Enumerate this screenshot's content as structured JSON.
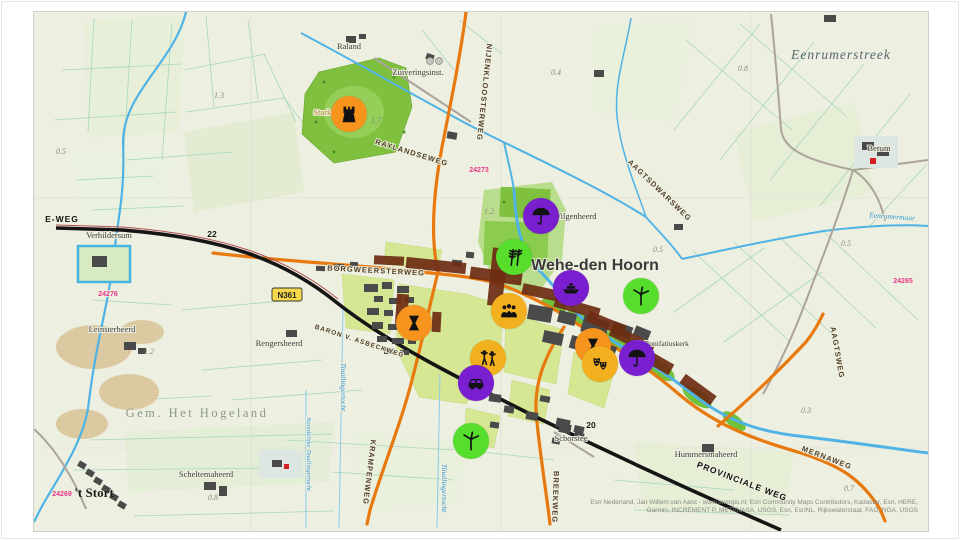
{
  "map": {
    "town_label": "Wehe-den Hoorn",
    "shield": {
      "text": "N361"
    },
    "region_labels": [
      {
        "text": "Eenrumerstreek",
        "x": 807,
        "y": 47
      },
      {
        "text": "Gem. Het Hogeland",
        "x": 163,
        "y": 405
      },
      {
        "text": "'t Stort",
        "x": 60,
        "y": 485
      }
    ],
    "place_labels": [
      {
        "text": "Raland",
        "x": 315,
        "y": 37
      },
      {
        "text": "Zuiveringsinst.",
        "x": 384,
        "y": 63
      },
      {
        "text": "Verhildersum",
        "x": 75,
        "y": 226
      },
      {
        "text": "Wilgenheerd",
        "x": 519,
        "y": 207,
        "anchor": "start"
      },
      {
        "text": "Leinsterheerd",
        "x": 78,
        "y": 320
      },
      {
        "text": "Rengersheerd",
        "x": 245,
        "y": 334
      },
      {
        "text": "Scheltemaheerd",
        "x": 172,
        "y": 465
      },
      {
        "text": "Schorstee",
        "x": 537,
        "y": 429
      },
      {
        "text": "Hummersmaheerd",
        "x": 672,
        "y": 445
      },
      {
        "text": "Berum",
        "x": 845,
        "y": 139
      },
      {
        "text": "H. Bonifatiuskerk",
        "x": 628,
        "y": 334,
        "size": 7.5
      },
      {
        "text": "Starkenborg",
        "x": 300,
        "y": 103,
        "cls": "lbl-park"
      }
    ],
    "road_labels": [
      {
        "text": "E-WEG",
        "x": 28,
        "y": 210,
        "cls": "lbl-road-black"
      },
      {
        "text": "BORGWEERSTERWEG",
        "x": 342,
        "y": 261,
        "rot": 3
      },
      {
        "text": "RAYLANDSEWEG",
        "x": 377,
        "y": 143,
        "rot": 17
      },
      {
        "text": "NIJENKLOOSTERWEG",
        "x": 448,
        "y": 80,
        "rot": 96
      },
      {
        "text": "AAGTSDWARSWEG",
        "x": 624,
        "y": 180,
        "rot": 44
      },
      {
        "text": "AAGTSWEG",
        "x": 801,
        "y": 341,
        "rot": 80
      },
      {
        "text": "MERNAWEG",
        "x": 792,
        "y": 448,
        "rot": 21
      },
      {
        "text": "BREEKWEG",
        "x": 519,
        "y": 485,
        "rot": 92
      },
      {
        "text": "KRAMPENWEG",
        "x": 333,
        "y": 460,
        "rot": 97
      },
      {
        "text": "BARON V. ASBECKWEG",
        "x": 325,
        "y": 331,
        "rot": 18,
        "size": 6.5
      },
      {
        "text": "PROVINCIALE WEG",
        "x": 707,
        "y": 472,
        "rot": 21,
        "cls": "lbl-road-black"
      }
    ],
    "water_labels": [
      {
        "text": "Eenrumermaar",
        "x": 858,
        "y": 207,
        "rot": 4
      },
      {
        "text": "Tinallingertocht",
        "x": 307,
        "y": 375,
        "rot": 90
      },
      {
        "text": "Noordelijke Tinallingertocht",
        "x": 273,
        "y": 442,
        "rot": 90,
        "size": 6.5
      },
      {
        "text": "Tinallingertocht",
        "x": 408,
        "y": 476,
        "rot": 90
      }
    ],
    "km_markers": [
      {
        "text": "22",
        "x": 178,
        "y": 225
      },
      {
        "text": "20",
        "x": 557,
        "y": 416
      }
    ],
    "route_numbers": [
      {
        "text": "24273",
        "x": 445,
        "y": 160
      },
      {
        "text": "24276",
        "x": 74,
        "y": 284
      },
      {
        "text": "24269",
        "x": 28,
        "y": 484
      },
      {
        "text": "24265",
        "x": 869,
        "y": 271
      }
    ],
    "parcel_numbers": [
      {
        "text": "1.3",
        "x": 185,
        "y": 86
      },
      {
        "text": "0.5",
        "x": 27,
        "y": 142
      },
      {
        "text": "1.7",
        "x": 342,
        "y": 111
      },
      {
        "text": "0.4",
        "x": 522,
        "y": 63
      },
      {
        "text": "0.8",
        "x": 709,
        "y": 59
      },
      {
        "text": "1.2",
        "x": 455,
        "y": 202
      },
      {
        "text": "0.5",
        "x": 624,
        "y": 240
      },
      {
        "text": "0.5",
        "x": 812,
        "y": 234
      },
      {
        "text": "1.2",
        "x": 115,
        "y": 342
      },
      {
        "text": "0.8",
        "x": 179,
        "y": 488
      },
      {
        "text": "0.3",
        "x": 772,
        "y": 401
      },
      {
        "text": "0.7",
        "x": 815,
        "y": 479
      }
    ],
    "attribution": [
      "Esri Nederland, Jan Willem van Aalst - www.imergis.nl; Esri Community Maps Contributors, Kadaster, Esri, HERE,",
      "Garmin, INCREMENT P, METI/NASA, USGS, Esri, EsriNL, Rijkswaterstaat, FAO, NGA, USGS"
    ],
    "markers": [
      {
        "name": "castle",
        "icon": "castle",
        "color": "#F7941E",
        "x": 315,
        "y": 102
      },
      {
        "name": "umbrella",
        "icon": "umbrella",
        "color": "#7A1FD0",
        "x": 507,
        "y": 204
      },
      {
        "name": "wheat",
        "icon": "wheat",
        "color": "#57DD2B",
        "x": 480,
        "y": 245
      },
      {
        "name": "boat",
        "icon": "boat",
        "color": "#7A1FD0",
        "x": 537,
        "y": 276
      },
      {
        "name": "wind-turbine",
        "icon": "turbine",
        "color": "#57DD2B",
        "x": 607,
        "y": 284
      },
      {
        "name": "people-group",
        "icon": "crowd",
        "color": "#F2B01E",
        "x": 475,
        "y": 299
      },
      {
        "name": "borg",
        "icon": "borg",
        "color": "#F7941E",
        "x": 380,
        "y": 311
      },
      {
        "name": "dancers",
        "icon": "dancers",
        "color": "#F2B01E",
        "x": 454,
        "y": 346
      },
      {
        "name": "borg",
        "icon": "borg",
        "color": "#F7941E",
        "x": 559,
        "y": 334
      },
      {
        "name": "theater-masks",
        "icon": "masks",
        "color": "#F2B01E",
        "x": 566,
        "y": 352
      },
      {
        "name": "umbrella",
        "icon": "umbrella",
        "color": "#7A1FD0",
        "x": 603,
        "y": 346
      },
      {
        "name": "car",
        "icon": "car",
        "color": "#7A1FD0",
        "x": 442,
        "y": 371
      },
      {
        "name": "wind-turbine",
        "icon": "turbine",
        "color": "#57DD2B",
        "x": 437,
        "y": 429
      }
    ],
    "colors": {
      "marker_orange": "#F7941E",
      "marker_purple": "#7A1FD0",
      "marker_green": "#57DD2B",
      "marker_yellow": "#F2B01E",
      "road_orange": "#E8790F",
      "road_black": "#151515",
      "water_blue": "#4FB3E6",
      "park_green": "#7FC13E",
      "shield_yellow": "#F6D84A",
      "route_pink": "#E6388A"
    }
  }
}
